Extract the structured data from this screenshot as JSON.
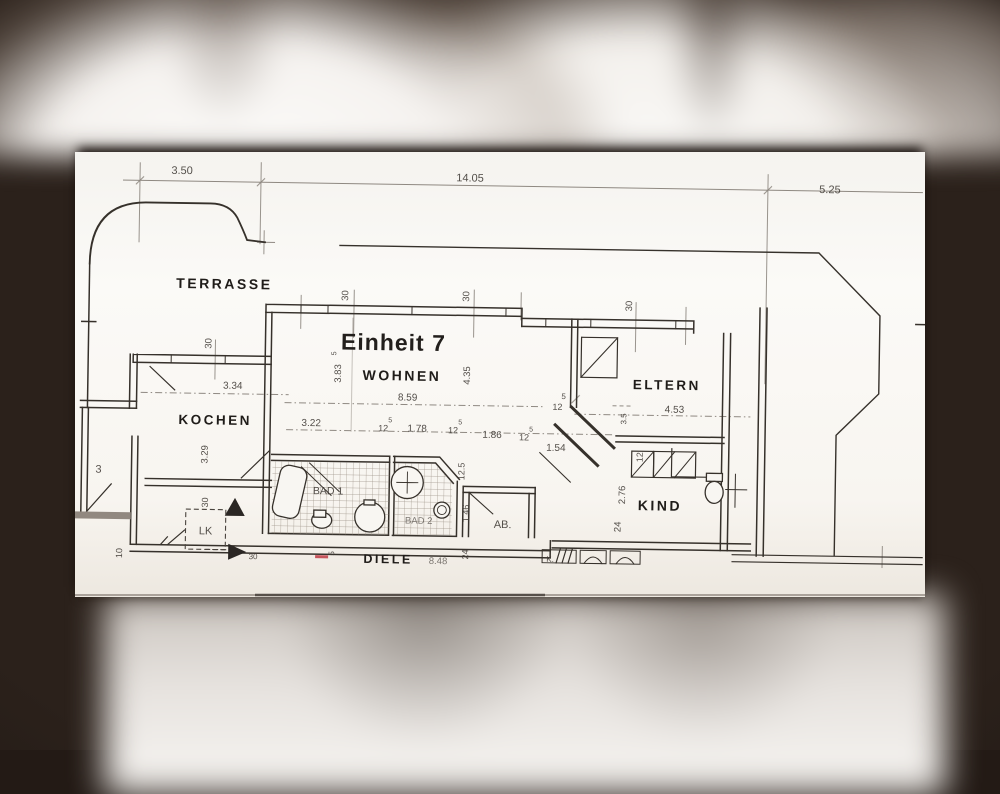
{
  "viewer": {
    "background": "#231a15"
  },
  "floorplan": {
    "unit_label": "Einheit 7",
    "accent_red": "#bf3a43",
    "rooms": {
      "terrasse": "TERRASSE",
      "wohnen": "WOHNEN",
      "kochen": "KOCHEN",
      "eltern": "ELTERN",
      "kind": "KIND",
      "bad1": "BAD 1",
      "bad2": "BAD 2",
      "ab": "AB.",
      "diele": "DIELE",
      "lk": "LK",
      "k": "K."
    },
    "dimensions": {
      "top_left": "3.50",
      "top_mid": "14.05",
      "top_right": "5.25",
      "w30": "30",
      "sup5": "5",
      "w12": "12",
      "wohnen_left": "3.83",
      "wohnen_right": "4.35",
      "wohnen_width": "8.59",
      "row_322": "3.22",
      "row_178": "1.78",
      "row_186": "1.86",
      "row_154": "1.54",
      "kochen_width": "3.34",
      "kochen_depth": "3.29",
      "kochen_3": "3",
      "eltern_width": "4.53",
      "eltern_side": "3.5",
      "bad_125": "12.5",
      "bad_146": "1.46",
      "kind_12": "12",
      "kind_276": "2.76",
      "kind_24": "24",
      "flur_24": "24",
      "diele_len": "8.48",
      "diele_5": "5",
      "left_10": "10",
      "lk_30": "30"
    }
  }
}
